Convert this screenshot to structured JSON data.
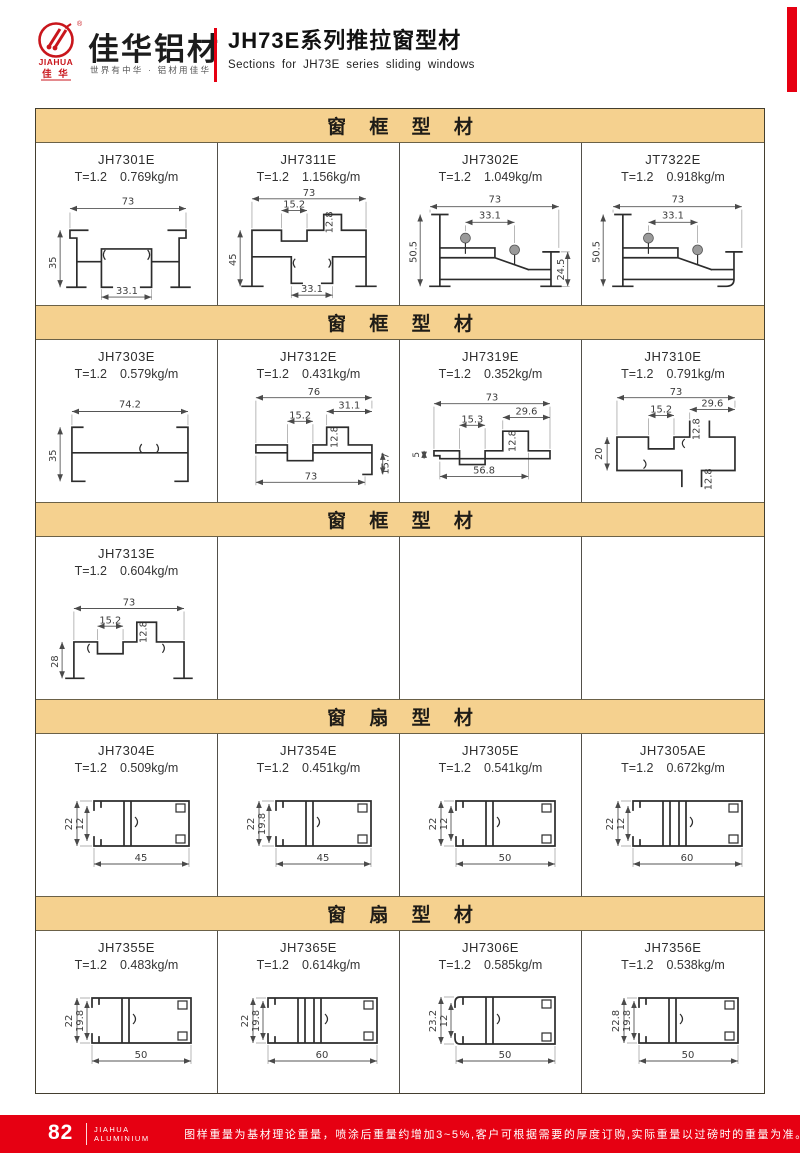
{
  "header": {
    "brand_name": "佳华铝材",
    "brand_mark": "JIAHUA",
    "brand_mark_cn": "佳 华",
    "registered": "®",
    "tagline": "世界有中华 · 铝材用佳华",
    "title_cn": "JH73E系列推拉窗型材",
    "title_en": "Sections for JH73E series sliding windows",
    "accent_red": "#E60012",
    "logo_red": "#C9161C"
  },
  "table": {
    "band_bg": "#F5D18F",
    "frame_band_label": "窗 框 型 材",
    "sash_band_label": "窗 扇 型 材"
  },
  "sections": [
    {
      "title": "窗 框 型 材",
      "cells": [
        {
          "code": "JH7301E",
          "spec_t": "T=1.2",
          "spec_w": "0.769kg/m",
          "dims": {
            "top": "73",
            "left": "35",
            "bottom": "33.1"
          }
        },
        {
          "code": "JH7311E",
          "spec_t": "T=1.2",
          "spec_w": "1.156kg/m",
          "dims": {
            "top": "73",
            "ch": "15.2",
            "box": "12.8",
            "left": "45",
            "bottom": "33.1"
          }
        },
        {
          "code": "JH7302E",
          "spec_t": "T=1.2",
          "spec_w": "1.049kg/m",
          "dims": {
            "top": "73",
            "inner": "33.1",
            "left": "50.5",
            "right": "24.5"
          }
        },
        {
          "code": "JT7322E",
          "spec_t": "T=1.2",
          "spec_w": "0.918kg/m",
          "dims": {
            "top": "73",
            "inner": "33.1",
            "left": "50.5"
          }
        }
      ]
    },
    {
      "title": "窗 框 型 材",
      "cells": [
        {
          "code": "JH7303E",
          "spec_t": "T=1.2",
          "spec_w": "0.579kg/m",
          "dims": {
            "top": "74.2",
            "left": "35"
          }
        },
        {
          "code": "JH7312E",
          "spec_t": "T=1.2",
          "spec_w": "0.431kg/m",
          "dims": {
            "top": "76",
            "rch": "31.1",
            "ch": "15.2",
            "box": "12.8",
            "bottom": "73",
            "right": "15.7"
          }
        },
        {
          "code": "JH7319E",
          "spec_t": "T=1.2",
          "spec_w": "0.352kg/m",
          "dims": {
            "top": "73",
            "ch": "15.3",
            "rch": "29.6",
            "box": "12.8",
            "left": "5",
            "bottom": "56.8"
          }
        },
        {
          "code": "JH7310E",
          "spec_t": "T=1.2",
          "spec_w": "0.791kg/m",
          "dims": {
            "top": "73",
            "ch": "15.2",
            "rch": "29.6",
            "box": "12.8",
            "left": "20",
            "bbox": "12.8"
          }
        }
      ]
    },
    {
      "title": "窗 框 型 材",
      "cells": [
        {
          "code": "JH7313E",
          "spec_t": "T=1.2",
          "spec_w": "0.604kg/m",
          "dims": {
            "top": "73",
            "ch": "15.2",
            "box": "12.8",
            "left": "28"
          }
        }
      ]
    },
    {
      "title": "窗 扇 型 材",
      "cells": [
        {
          "code": "JH7304E",
          "spec_t": "T=1.2",
          "spec_w": "0.509kg/m",
          "dims": {
            "left": "22",
            "inner": "12",
            "bottom": "45"
          }
        },
        {
          "code": "JH7354E",
          "spec_t": "T=1.2",
          "spec_w": "0.451kg/m",
          "dims": {
            "left": "22",
            "inner": "19.8",
            "bottom": "45"
          }
        },
        {
          "code": "JH7305E",
          "spec_t": "T=1.2",
          "spec_w": "0.541kg/m",
          "dims": {
            "left": "22",
            "inner": "12",
            "bottom": "50"
          }
        },
        {
          "code": "JH7305AE",
          "spec_t": "T=1.2",
          "spec_w": "0.672kg/m",
          "dims": {
            "left": "22",
            "inner": "12",
            "bottom": "60"
          }
        }
      ]
    },
    {
      "title": "窗 扇 型 材",
      "cells": [
        {
          "code": "JH7355E",
          "spec_t": "T=1.2",
          "spec_w": "0.483kg/m",
          "dims": {
            "left": "22",
            "inner": "19.8",
            "bottom": "50"
          }
        },
        {
          "code": "JH7365E",
          "spec_t": "T=1.2",
          "spec_w": "0.614kg/m",
          "dims": {
            "left": "22",
            "inner": "19.8",
            "bottom": "60"
          }
        },
        {
          "code": "JH7306E",
          "spec_t": "T=1.2",
          "spec_w": "0.585kg/m",
          "dims": {
            "left": "23.2",
            "inner": "12",
            "bottom": "50"
          }
        },
        {
          "code": "JH7356E",
          "spec_t": "T=1.2",
          "spec_w": "0.538kg/m",
          "dims": {
            "left": "22.8",
            "inner": "19.8",
            "bottom": "50"
          }
        }
      ]
    }
  ],
  "footer": {
    "page_number": "82",
    "brand_line1": "JIAHUA",
    "brand_line2": "ALUMINIUM",
    "note": "图样重量为基材理论重量，喷涂后重量约增加3~5%,客户可根据需要的厚度订购,实际重量以过磅时的重量为准。",
    "bar_color": "#E60012"
  }
}
